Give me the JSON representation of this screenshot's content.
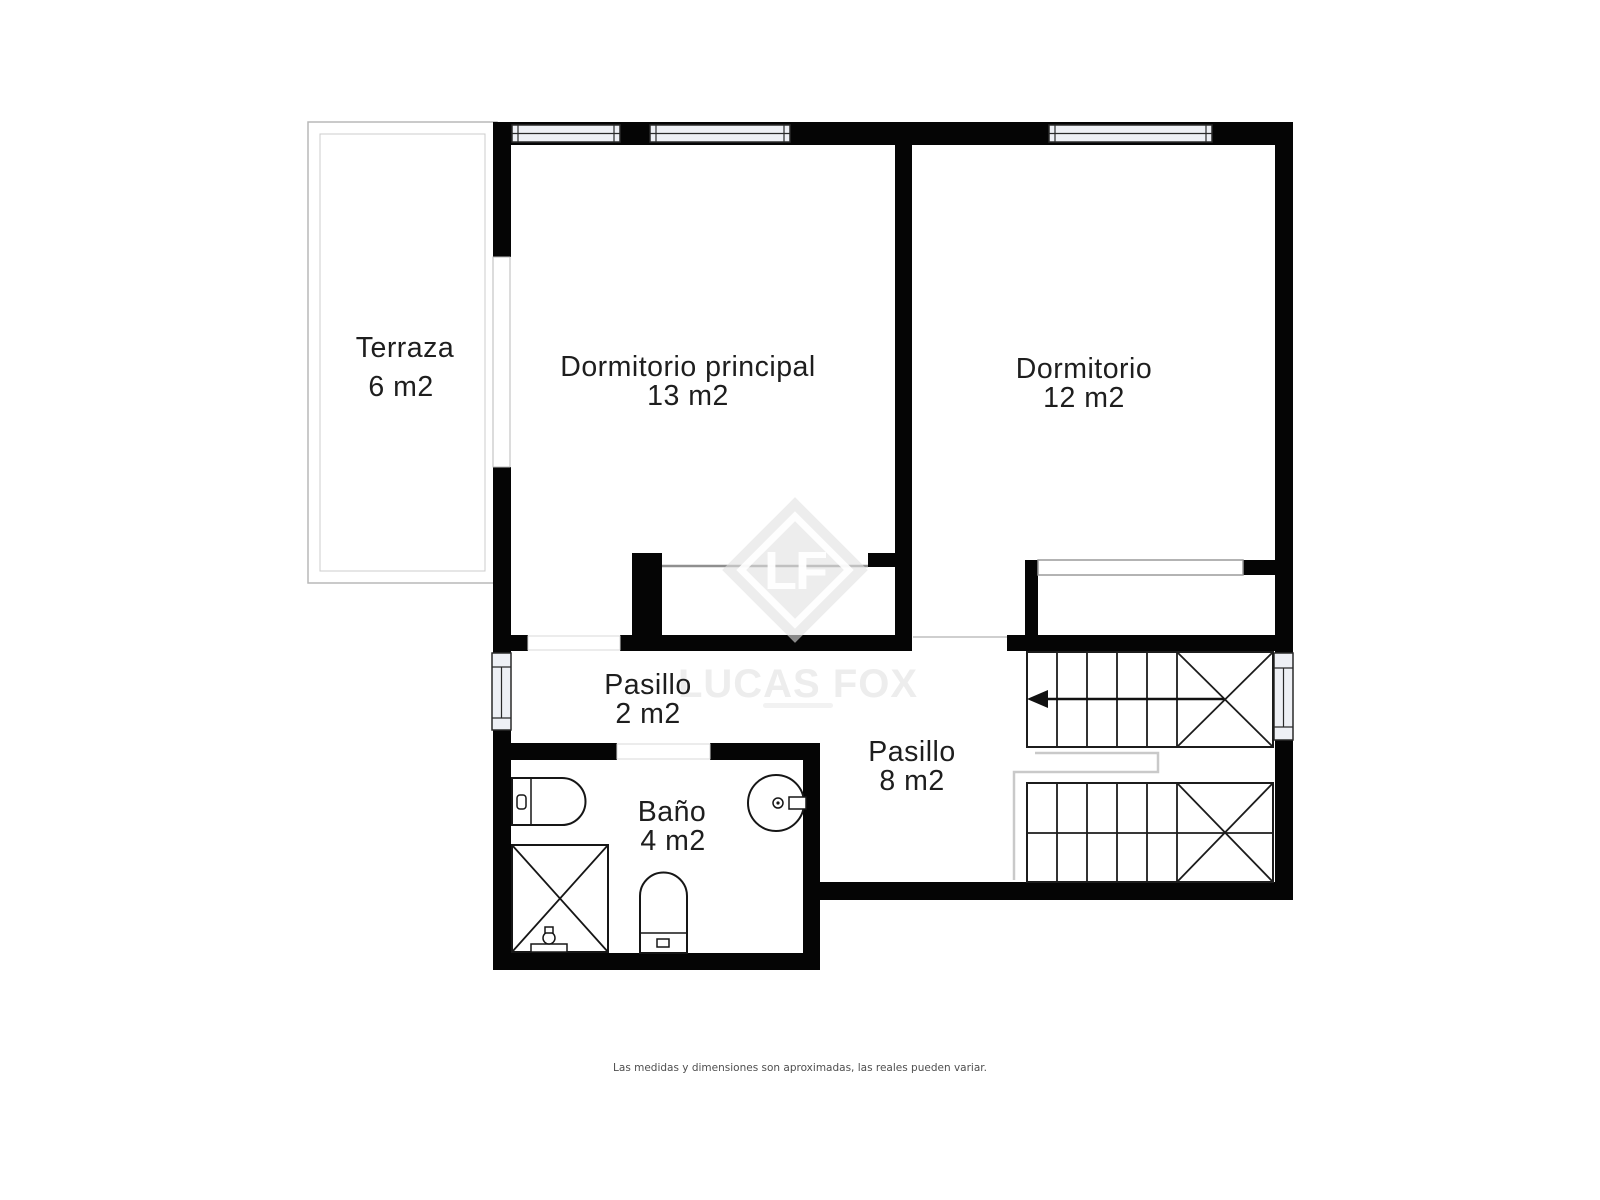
{
  "plan": {
    "rooms": [
      {
        "id": "terraza",
        "name": "Terraza",
        "area": "6 m2"
      },
      {
        "id": "dormitorio-principal",
        "name": "Dormitorio principal",
        "area": "13 m2"
      },
      {
        "id": "dormitorio",
        "name": "Dormitorio",
        "area": "12 m2"
      },
      {
        "id": "pasillo-2",
        "name": "Pasillo",
        "area": "2 m2"
      },
      {
        "id": "pasillo-8",
        "name": "Pasillo",
        "area": "8 m2"
      },
      {
        "id": "bano",
        "name": "Baño",
        "area": "4 m2"
      }
    ],
    "fixtures": [
      "toilet",
      "shower",
      "bidet",
      "washbasin"
    ],
    "stairs": {
      "arrow_direction": "left"
    },
    "colors": {
      "wall": "#050505",
      "window_fill": "#eef0f5",
      "label_text": "#1e1e1e",
      "light_line": "#c9c9c9",
      "disclaimer_text": "#4f4f4f",
      "watermark_gray": "#ececec"
    }
  },
  "watermark": {
    "monogram": "LF",
    "brand": "LUCAS FOX"
  },
  "footer": {
    "disclaimer": "Las medidas y dimensiones son aproximadas, las reales pueden variar."
  }
}
